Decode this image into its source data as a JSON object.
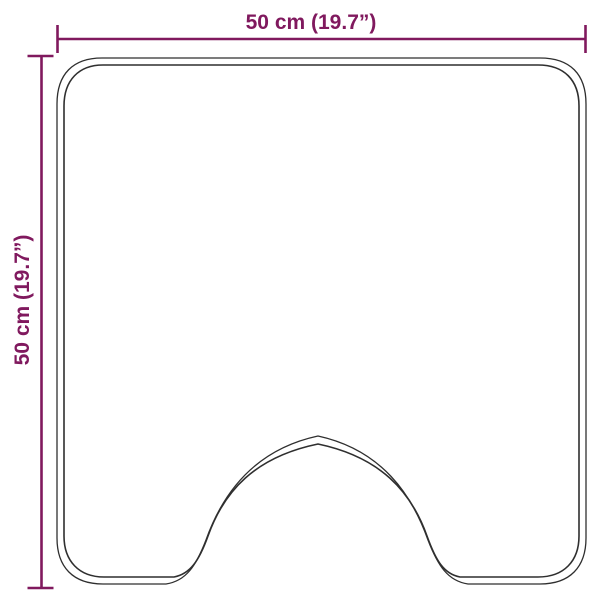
{
  "diagram": {
    "shape": "contour-mat-outline",
    "dimensions": {
      "width": {
        "label": "50 cm (19.7”)"
      },
      "height": {
        "label": "50 cm (19.7”)"
      }
    },
    "colors": {
      "dimension_accent": "#80195e",
      "outline": "#2f2f2f",
      "background": "#ffffff"
    }
  }
}
